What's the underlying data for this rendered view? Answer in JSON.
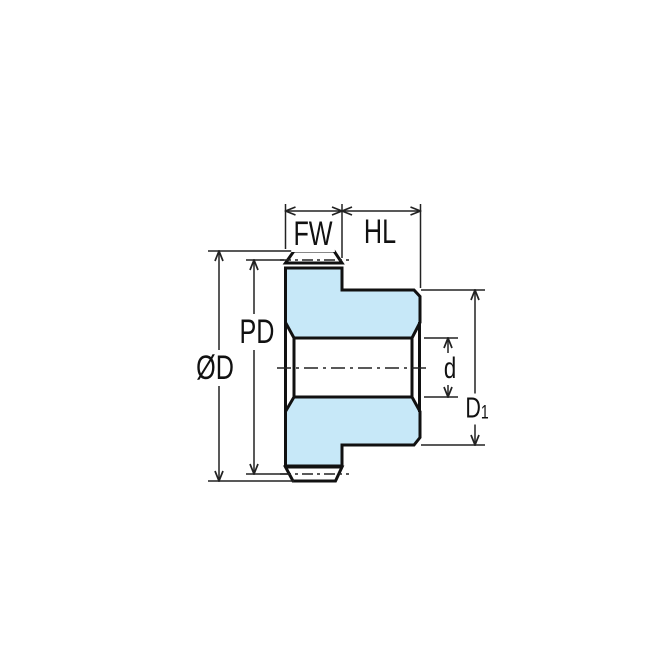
{
  "drawing": {
    "description": "Technical side cross-section drawing of a spur gear with hub, bore and dimension callouts",
    "labels": {
      "face_width": "FW",
      "hub_length": "HL",
      "pitch_diameter": "PD",
      "outside_diameter": "ØD",
      "bore_diameter": "d",
      "hub_diameter_main": "D",
      "hub_diameter_sub": "1"
    },
    "colors": {
      "part_fill": "#c7e8f8",
      "outline": "#111111",
      "dimension": "#222222",
      "background": "#ffffff"
    }
  }
}
